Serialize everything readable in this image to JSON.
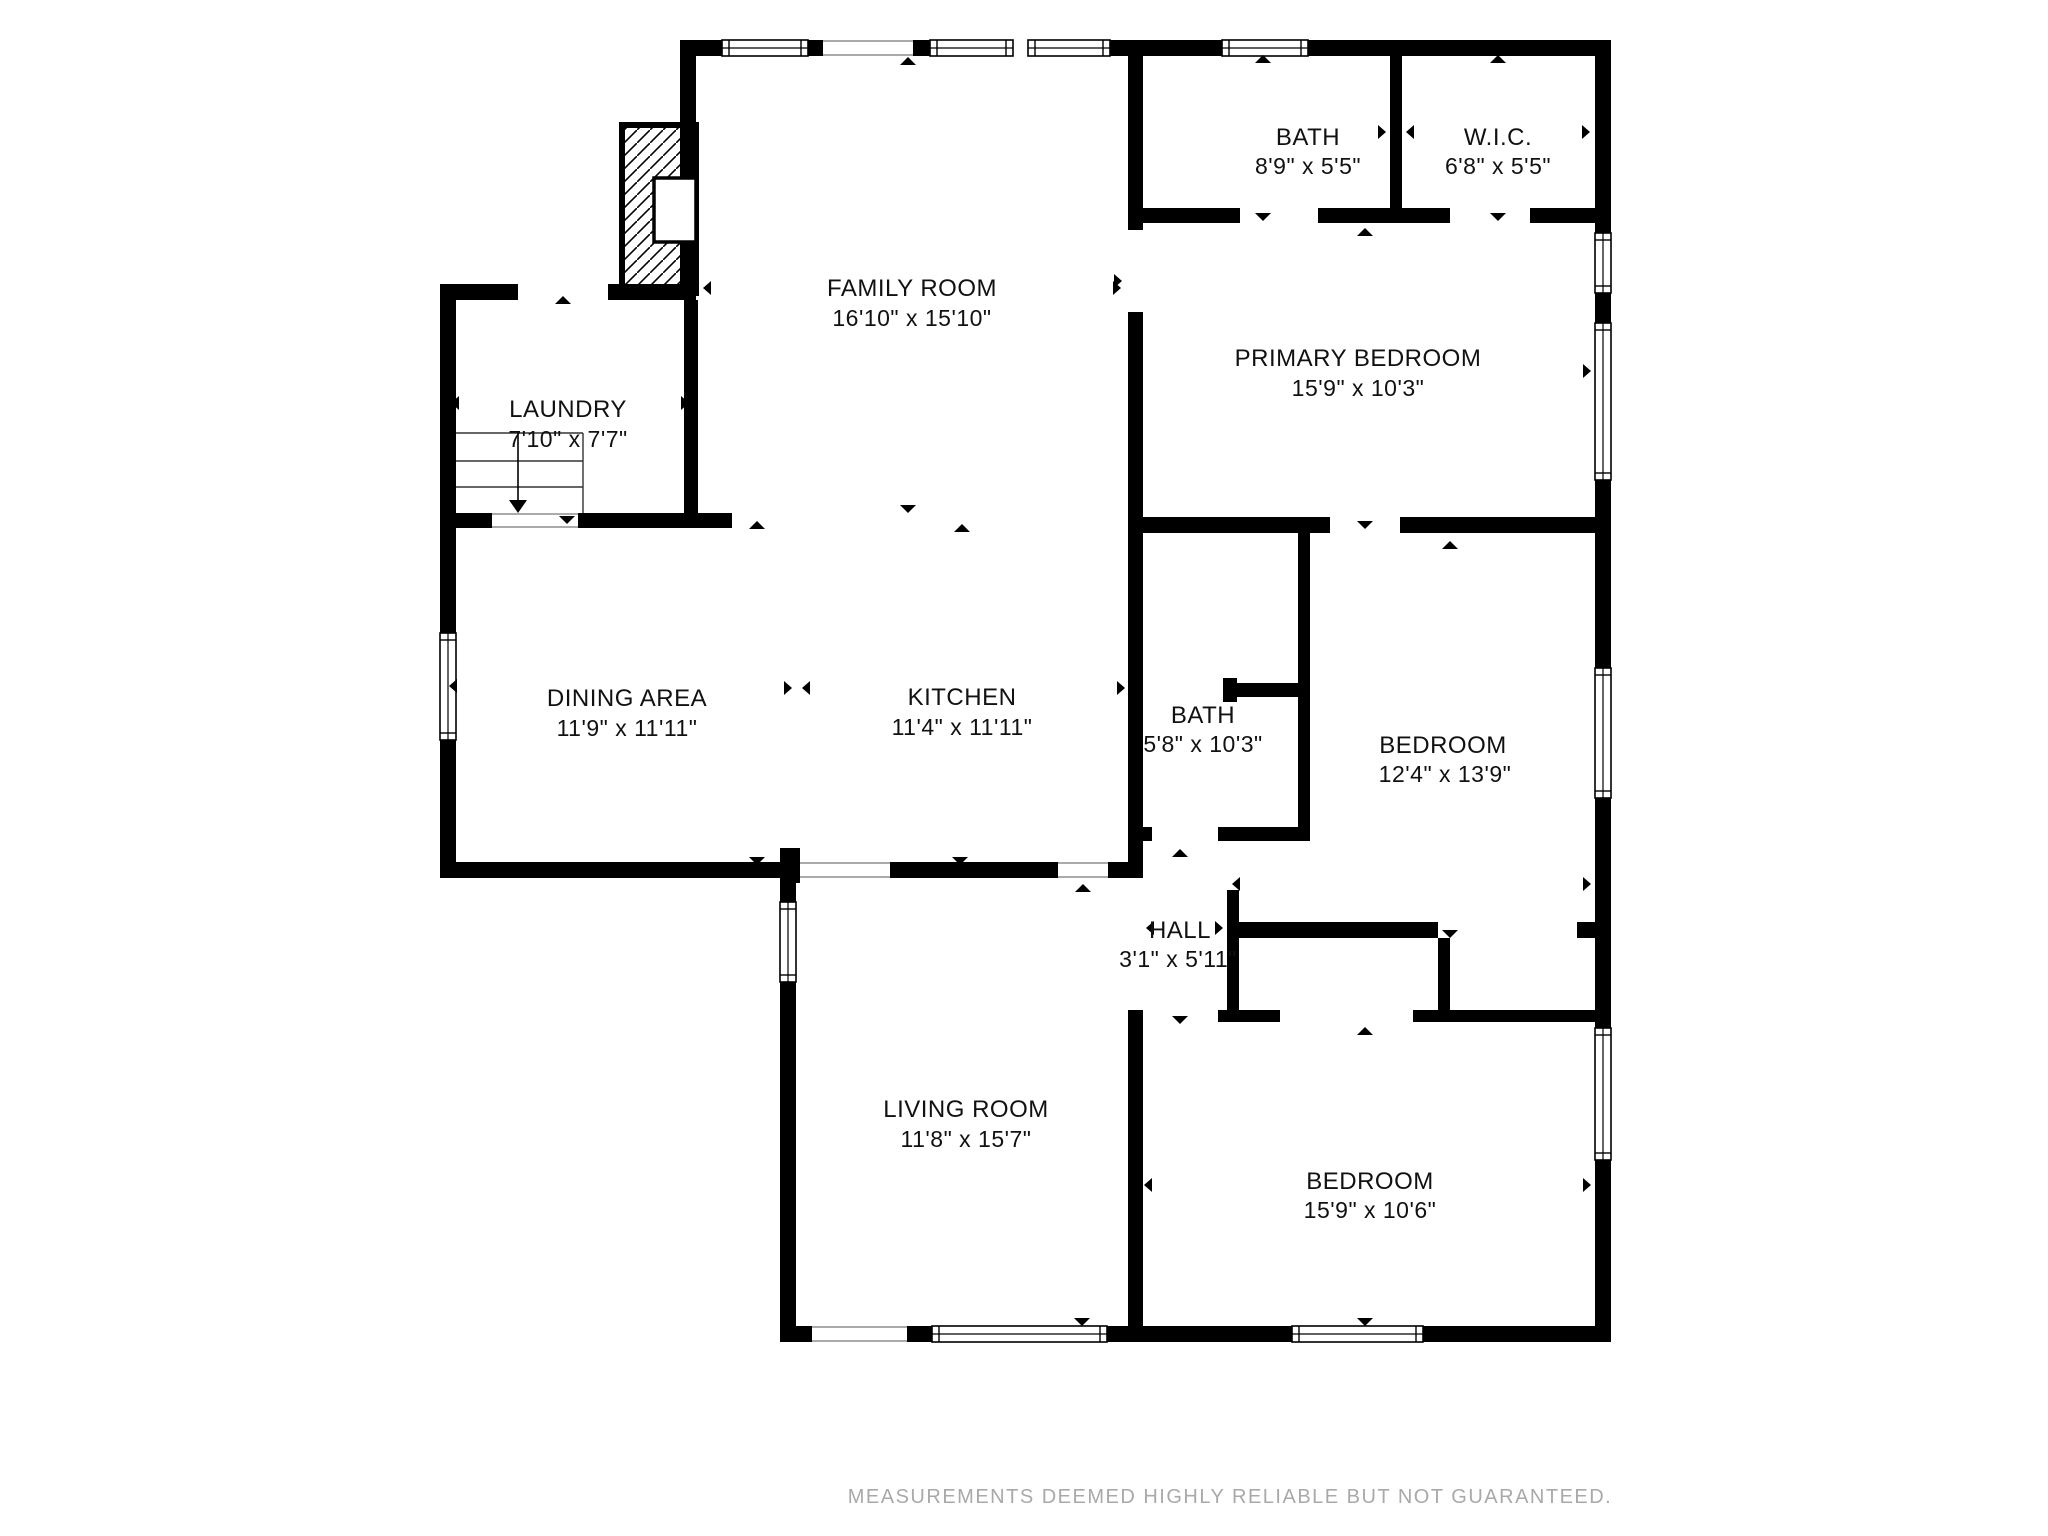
{
  "page": {
    "background": "#ffffff",
    "wall_color": "#000000",
    "accent_gray": "#a9a9a9"
  },
  "disclaimer": {
    "text": "MEASUREMENTS DEEMED HIGHLY RELIABLE BUT NOT GUARANTEED."
  },
  "plan": {
    "rooms": [
      {
        "id": "family-room",
        "name": "FAMILY ROOM",
        "dims": "16'10\" x 15'10\""
      },
      {
        "id": "bath-top",
        "name": "BATH",
        "dims": "8'9\" x 5'5\""
      },
      {
        "id": "wic",
        "name": "W.I.C.",
        "dims": "6'8\" x 5'5\""
      },
      {
        "id": "primary-bedroom",
        "name": "PRIMARY BEDROOM",
        "dims": "15'9\" x 10'3\""
      },
      {
        "id": "laundry",
        "name": "LAUNDRY",
        "dims": "7'10\" x 7'7\""
      },
      {
        "id": "dining-area",
        "name": "DINING AREA",
        "dims": "11'9\" x 11'11\""
      },
      {
        "id": "kitchen",
        "name": "KITCHEN",
        "dims": "11'4\" x 11'11\""
      },
      {
        "id": "bath-middle",
        "name": "BATH",
        "dims": "5'8\" x 10'3\""
      },
      {
        "id": "bedroom-right",
        "name": "BEDROOM",
        "dims": "12'4\" x 13'9\""
      },
      {
        "id": "hall",
        "name": "HALL",
        "dims": "3'1\" x 5'11\""
      },
      {
        "id": "living-room",
        "name": "LIVING ROOM",
        "dims": "11'8\" x 15'7\""
      },
      {
        "id": "bedroom-bottom",
        "name": "BEDROOM",
        "dims": "15'9\" x 10'6\""
      }
    ],
    "walls": [
      [
        680,
        40,
        42,
        16
      ],
      [
        808,
        40,
        15,
        16
      ],
      [
        913,
        40,
        17,
        16
      ],
      [
        1110,
        40,
        112,
        16
      ],
      [
        1308,
        40,
        303,
        16
      ],
      [
        1595,
        40,
        16,
        193
      ],
      [
        1595,
        293,
        16,
        30
      ],
      [
        1595,
        480,
        16,
        188
      ],
      [
        1595,
        798,
        16,
        230
      ],
      [
        1595,
        1160,
        16,
        182
      ],
      [
        440,
        284,
        16,
        594
      ],
      [
        680,
        56,
        16,
        228
      ],
      [
        684,
        300,
        14,
        213
      ],
      [
        440,
        284,
        78,
        16
      ],
      [
        608,
        284,
        88,
        16
      ],
      [
        440,
        513,
        52,
        15
      ],
      [
        578,
        513,
        154,
        15
      ],
      [
        440,
        862,
        340,
        16
      ],
      [
        780,
        848,
        20,
        35
      ],
      [
        780,
        883,
        16,
        19
      ],
      [
        780,
        982,
        16,
        360
      ],
      [
        890,
        862,
        168,
        16
      ],
      [
        1108,
        862,
        35,
        16
      ],
      [
        1128,
        56,
        15,
        174
      ],
      [
        1128,
        312,
        15,
        566
      ],
      [
        1128,
        1010,
        15,
        332
      ],
      [
        1128,
        208,
        112,
        15
      ],
      [
        1318,
        208,
        132,
        15
      ],
      [
        1530,
        208,
        81,
        15
      ],
      [
        1390,
        56,
        12,
        152
      ],
      [
        1128,
        517,
        202,
        16
      ],
      [
        1400,
        517,
        211,
        16
      ],
      [
        1138,
        827,
        14,
        14
      ],
      [
        1218,
        827,
        92,
        14
      ],
      [
        1298,
        533,
        12,
        294
      ],
      [
        1223,
        683,
        87,
        14
      ],
      [
        1223,
        678,
        14,
        24
      ],
      [
        1227,
        890,
        12,
        132
      ],
      [
        1227,
        922,
        211,
        16
      ],
      [
        1577,
        922,
        18,
        16
      ],
      [
        1438,
        938,
        12,
        72
      ],
      [
        1218,
        1010,
        62,
        12
      ],
      [
        1413,
        1010,
        182,
        12
      ],
      [
        780,
        1326,
        32,
        16
      ],
      [
        907,
        1326,
        25,
        16
      ],
      [
        1107,
        1326,
        185,
        16
      ],
      [
        1423,
        1326,
        188,
        16
      ]
    ],
    "windows": [
      [
        722,
        40,
        86,
        16,
        "h"
      ],
      [
        930,
        40,
        83,
        16,
        "h"
      ],
      [
        1028,
        40,
        82,
        16,
        "h"
      ],
      [
        1222,
        40,
        86,
        16,
        "h"
      ],
      [
        1595,
        233,
        16,
        60,
        "v"
      ],
      [
        1595,
        323,
        16,
        157,
        "v"
      ],
      [
        1595,
        668,
        16,
        130,
        "v"
      ],
      [
        1595,
        1028,
        16,
        132,
        "v"
      ],
      [
        440,
        633,
        16,
        107,
        "v"
      ],
      [
        780,
        902,
        16,
        80,
        "v"
      ],
      [
        932,
        1326,
        175,
        16,
        "h"
      ],
      [
        1292,
        1326,
        131,
        16,
        "h"
      ]
    ],
    "openings": [
      [
        823,
        40,
        90,
        16,
        "h"
      ],
      [
        800,
        862,
        90,
        16,
        "h"
      ],
      [
        1058,
        862,
        50,
        16,
        "h"
      ],
      [
        812,
        1326,
        95,
        16,
        "h"
      ],
      [
        492,
        513,
        86,
        15,
        "h"
      ]
    ],
    "markers": {
      "up": [
        [
          563,
          296
        ],
        [
          908,
          57
        ],
        [
          962,
          524
        ],
        [
          757,
          521
        ],
        [
          1263,
          55
        ],
        [
          1498,
          55
        ],
        [
          1365,
          228
        ],
        [
          1450,
          541
        ],
        [
          1180,
          849
        ],
        [
          1083,
          884
        ],
        [
          1365,
          1027
        ]
      ],
      "down": [
        [
          567,
          516
        ],
        [
          908,
          505
        ],
        [
          757,
          857
        ],
        [
          960,
          857
        ],
        [
          1263,
          213
        ],
        [
          1498,
          213
        ],
        [
          1365,
          521
        ],
        [
          1450,
          930
        ],
        [
          1180,
          1016
        ],
        [
          1082,
          1318
        ],
        [
          1365,
          1318
        ]
      ],
      "left": [
        [
          451,
          403
        ],
        [
          449,
          686
        ],
        [
          1134,
          131
        ],
        [
          1406,
          132
        ],
        [
          1133,
          374
        ],
        [
          1232,
          884
        ],
        [
          1146,
          928
        ],
        [
          703,
          288
        ],
        [
          1144,
          1185
        ]
      ],
      "right": [
        [
          689,
          403
        ],
        [
          1125,
          688
        ],
        [
          1386,
          132
        ],
        [
          1590,
          132
        ],
        [
          1591,
          371
        ],
        [
          1591,
          884
        ],
        [
          1223,
          928
        ],
        [
          1121,
          288
        ],
        [
          1591,
          1185
        ],
        [
          1122,
          281
        ],
        [
          792,
          688
        ]
      ],
      "bowtie_left": [
        [
          802,
          688
        ]
      ]
    },
    "stairs": {
      "x1": 456,
      "x2": 583,
      "top": 433,
      "bottom": 513,
      "treads": [
        433,
        461,
        487
      ],
      "divider_x": 518,
      "arrow": {
        "x": 518,
        "y1": 433,
        "y2": 500
      }
    },
    "chimney": {
      "outer": [
        622,
        125,
        74,
        168
      ],
      "firebox": [
        654,
        178,
        42,
        64
      ]
    }
  }
}
